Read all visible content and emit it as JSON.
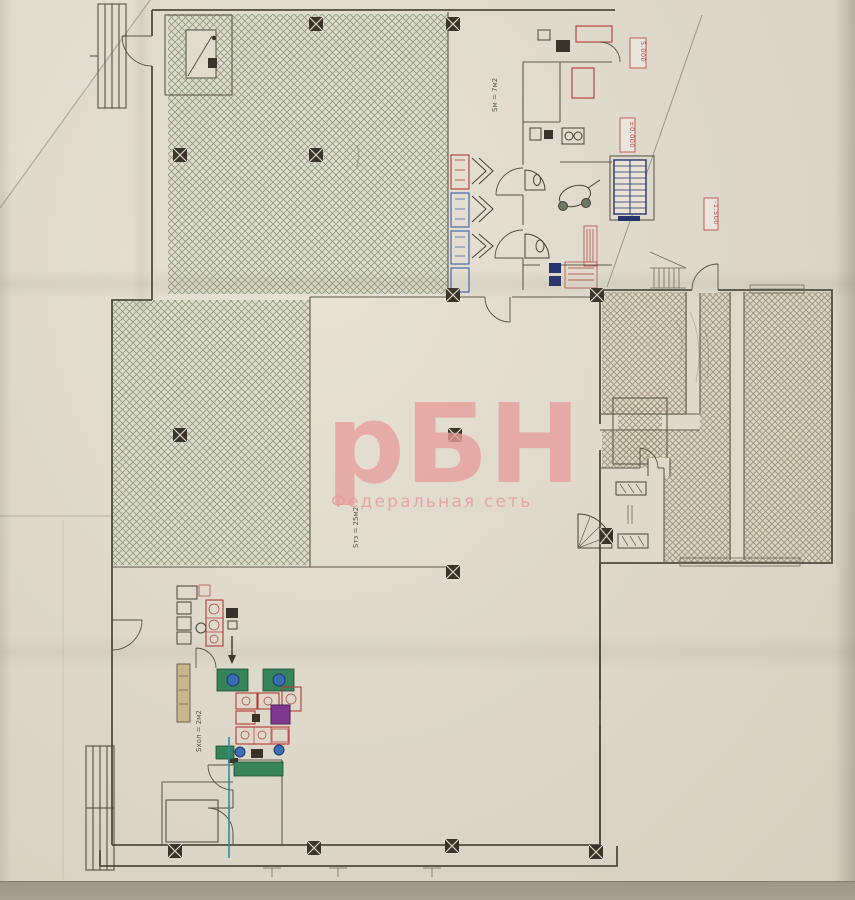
{
  "scan": {
    "type": "floor-plan-photocopy",
    "watermark_logo": "рБН",
    "watermark_subtitle": "Федеральная сеть"
  },
  "plan_labels": {
    "elevation_top": "5.000",
    "elevation_mid": "±0.000",
    "elevation_right": "-1.500",
    "area_label_top": "Sм = 7м2",
    "area_label_hall": "Sтз = 25м2",
    "area_label_cold": "Sхол = 2м2"
  },
  "colors": {
    "watermark": "#e79d9b",
    "hatch_sales": "#8d9c7e",
    "hatch_storage": "#9a8d77",
    "equipment_red": "#b23b35",
    "equipment_blue": "#3a5fa8",
    "equipment_green": "#37835b",
    "equipment_purple": "#80378f",
    "pipe_teal": "#2e8fa3",
    "elevation_red": "#c05048"
  }
}
